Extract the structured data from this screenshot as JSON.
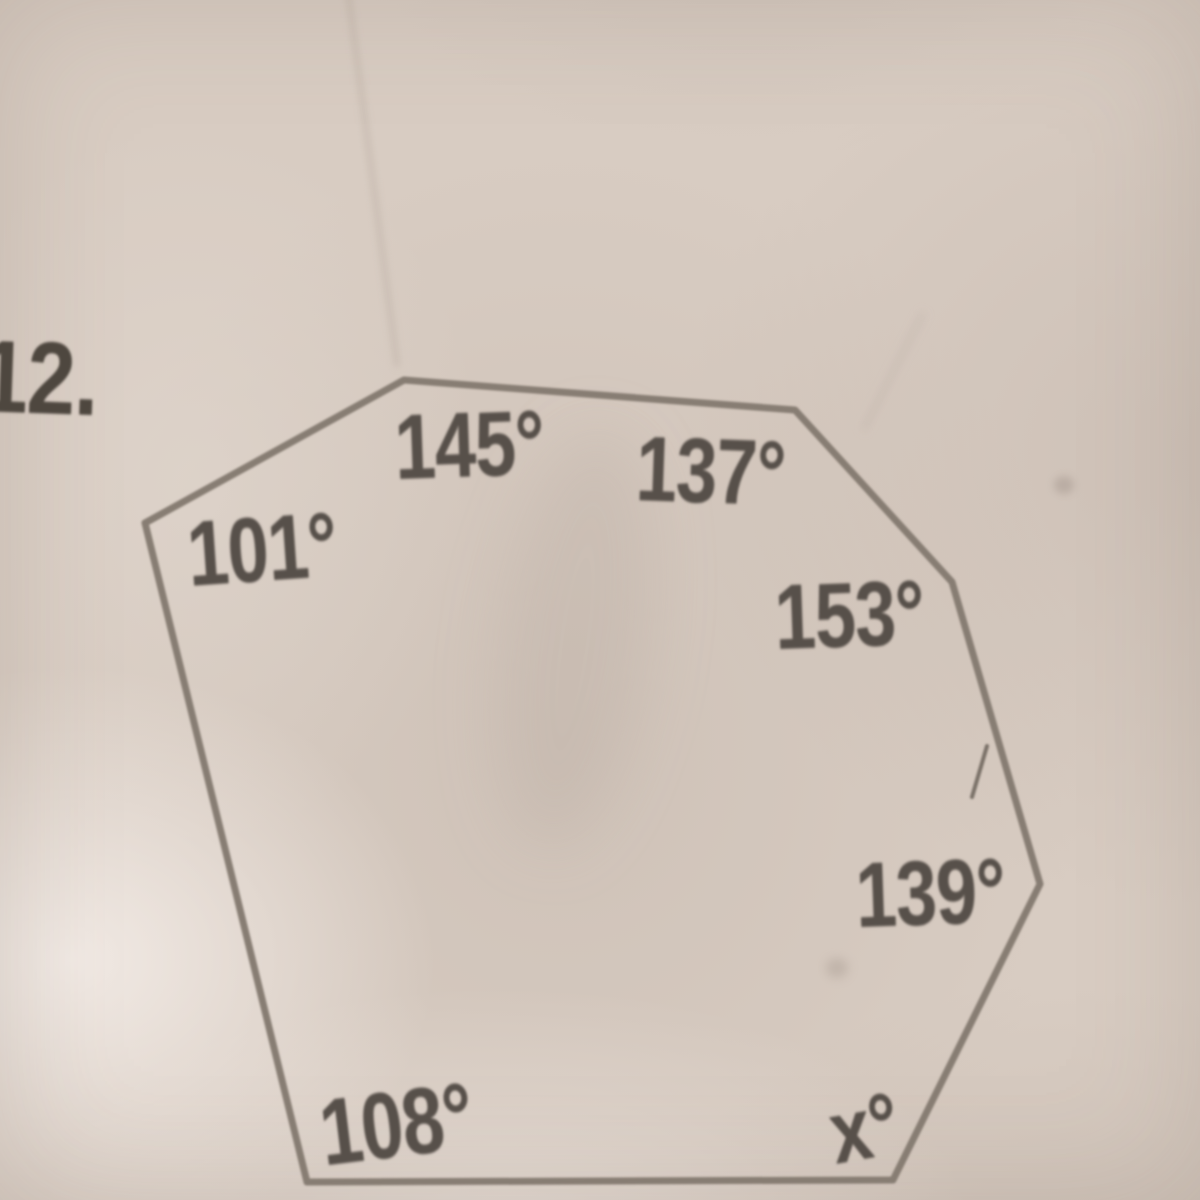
{
  "problem": {
    "number": "12.",
    "description": "heptagon with labeled interior angles, solve for x",
    "angle_sum_degrees": 900
  },
  "labels": {
    "problem_number": "12.",
    "angle_101": "101°",
    "angle_145": "145°",
    "angle_137": "137°",
    "angle_153": "153°",
    "angle_139": "139°",
    "angle_108": "108°",
    "angle_x": "x°"
  },
  "diagram": {
    "shape": "heptagon",
    "stroke_color": "#877d73",
    "stroke_width": 7,
    "text_color": "#57504a",
    "paper_color": "#d8ccc2",
    "vertices": [
      {
        "x": 145,
        "y": 523,
        "angle": "101°"
      },
      {
        "x": 404,
        "y": 380,
        "angle": "145°"
      },
      {
        "x": 795,
        "y": 410,
        "angle": "137°"
      },
      {
        "x": 952,
        "y": 582,
        "angle": "153°"
      },
      {
        "x": 1040,
        "y": 884,
        "angle": "139°"
      },
      {
        "x": 893,
        "y": 1180,
        "angle": "x°"
      },
      {
        "x": 307,
        "y": 1182,
        "angle": "108°"
      }
    ],
    "pencil_mark": {
      "x1": 987,
      "y1": 746,
      "x2": 972,
      "y2": 797
    }
  }
}
